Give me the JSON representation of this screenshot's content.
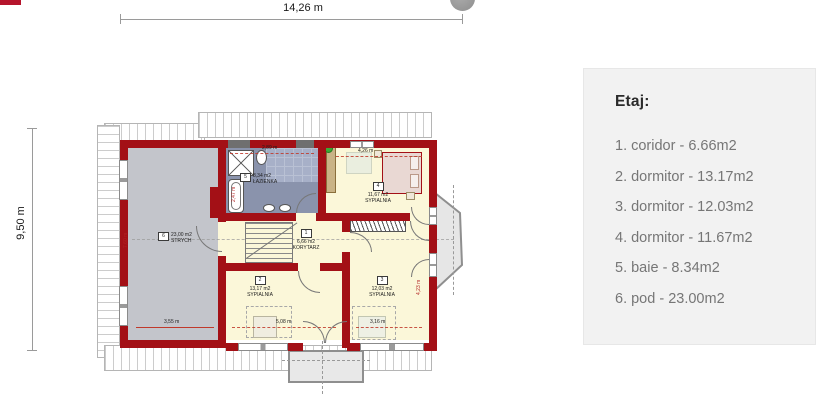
{
  "outer_dims": {
    "width": "14,26 m",
    "height": "9,50 m"
  },
  "plan": {
    "rooms": [
      {
        "no": "1",
        "area": "6,66 m2",
        "name": "KORYTARZ"
      },
      {
        "no": "2",
        "area": "13,17 m2",
        "name": "SYPIALNIA"
      },
      {
        "no": "3",
        "area": "12,03 m2",
        "name": "SYPIALNIA"
      },
      {
        "no": "4",
        "area": "11,67 m2",
        "name": "SYPIALNIA"
      },
      {
        "no": "5",
        "area": "8,34 m2",
        "name": "ŁAZIENKA"
      },
      {
        "no": "6",
        "area": "23,00 m2",
        "name": "STRYCH"
      }
    ],
    "dims": {
      "bath_top": "2,89 m",
      "room4_top": "4,26 m",
      "strych_bottom": "3,55 m",
      "room2_bottom": "5,08 m",
      "room3_bottom": "3,16 m",
      "tub_side": "2,47 m",
      "strych_side": "7,60 m",
      "room3_side": "4,23 m"
    }
  },
  "legend": {
    "title": "Etaj:",
    "items": [
      "1. coridor - 6.66m2",
      "2. dormitor - 13.17m2",
      "3. dormitor - 12.03m2",
      "4. dormitor - 11.67m2",
      "5. baie - 8.34m2",
      "6. pod - 23.00m2"
    ]
  },
  "colors": {
    "wall": "#a31016",
    "room_yellow": "#fbf7d9",
    "attic_gray": "#c3c5cb",
    "bath_blue": "#8a93ac",
    "accent_red": "#b5142c",
    "legend_bg": "#f2f2f2",
    "legend_text": "#767676",
    "roof_line": "#b5b5b5"
  }
}
